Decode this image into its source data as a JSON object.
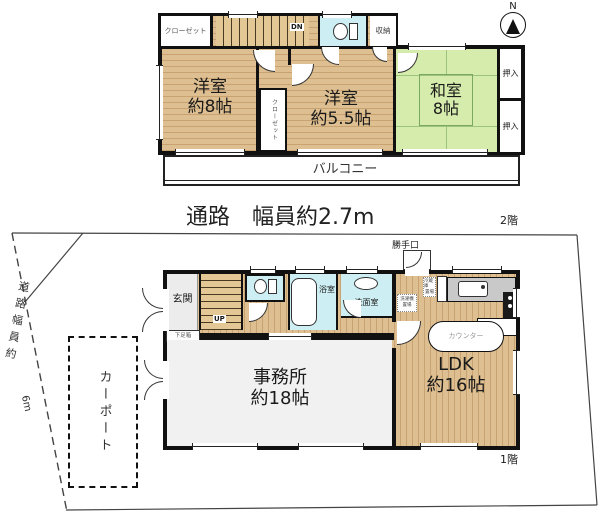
{
  "colors": {
    "wall": "#111111",
    "wood_floor": "#d8b684",
    "tatami": "#d5ecad",
    "wet_area": "#cdeef2",
    "office_floor": "#f1f1f1",
    "kitchen_counter": "#c9c9c9"
  },
  "compass": {
    "label": "N"
  },
  "floor2": {
    "floor_label": "2階",
    "closet_top": "クローゼット",
    "stairs_label": "DN",
    "storage": "収納",
    "western8_line1": "洋室",
    "western8_line2": "約8帖",
    "closet_mid": "クローゼット",
    "western55_line1": "洋室",
    "western55_line2": "約5.5帖",
    "japanese_line1": "和室",
    "japanese_line2": "8帖",
    "oshiire_top": "押入",
    "oshiire_bottom": "押入",
    "balcony": "バルコニー"
  },
  "passage": {
    "label": "通路　幅員約2.7m"
  },
  "floor1": {
    "floor_label": "1階",
    "entrance": "玄関",
    "shoe_cabinet": "下足箱",
    "stairs_label": "UP",
    "bath": "浴室",
    "washroom": "洗面室",
    "back_door": "勝手口",
    "fridge_line1": "冷蔵庫",
    "fridge_line2": "置場",
    "laundry_line1": "洗濯機",
    "laundry_line2": "置場",
    "counter": "カウンター",
    "office_line1": "事務所",
    "office_line2": "約18帖",
    "ldk_line1": "LDK",
    "ldk_line2": "約16帖"
  },
  "site": {
    "carport": "カーポート",
    "road_label": "道路幅員約",
    "road_width": "6m"
  }
}
